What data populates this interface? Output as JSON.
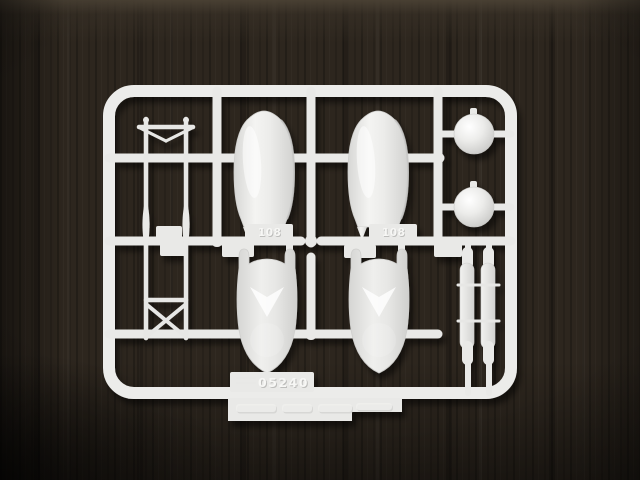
{
  "photo": {
    "alt": "White injection-molded model kit sprue with seaplane float parts, struts and dome parts, photographed on a dark wooden table",
    "colors": {
      "plastic": "#e9e9e7",
      "plastic-bright": "#f7f7f5",
      "plastic-shade": "#c4c4c2",
      "wood-light": "#4a4134",
      "wood-mid": "#2d261e",
      "wood-dark": "#1b1610"
    },
    "sprue": {
      "mold_number": "05240",
      "part_tags": [
        {
          "label": "108"
        },
        {
          "label": "108"
        }
      ]
    }
  }
}
